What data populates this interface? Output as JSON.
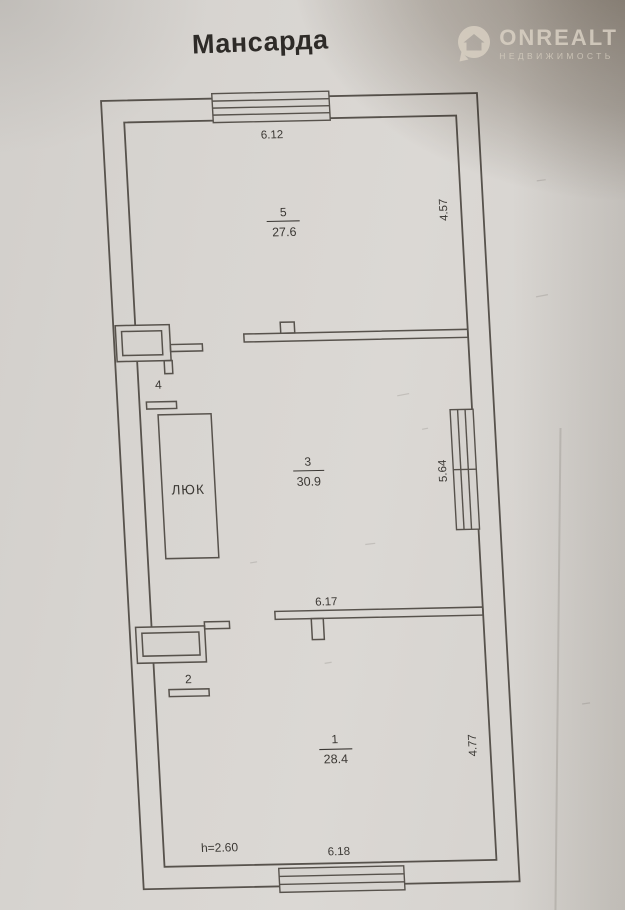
{
  "title": "Мансарда",
  "watermark": {
    "brand": "ONREALT",
    "tagline": "НЕДВИЖИМОСТЬ",
    "icon": "house-pin-icon"
  },
  "plan": {
    "hatch_label": "ЛЮК",
    "ceiling_height": "h=2.60",
    "rooms": [
      {
        "number": "5",
        "area": "27.6"
      },
      {
        "number": "3",
        "area": "30.9"
      },
      {
        "number": "1",
        "area": "28.4"
      },
      {
        "number": "4"
      },
      {
        "number": "2"
      }
    ],
    "dimensions": {
      "top_width": "6.12",
      "upper_right_height": "4.57",
      "middle_right_height": "5.64",
      "middle_width": "6.17",
      "lower_right_height": "4.77",
      "bottom_width": "6.18"
    },
    "colors": {
      "line": "#57524c",
      "text": "#3b3834",
      "paper": "#d7d4d0",
      "shadow": "#a59a8c"
    }
  }
}
